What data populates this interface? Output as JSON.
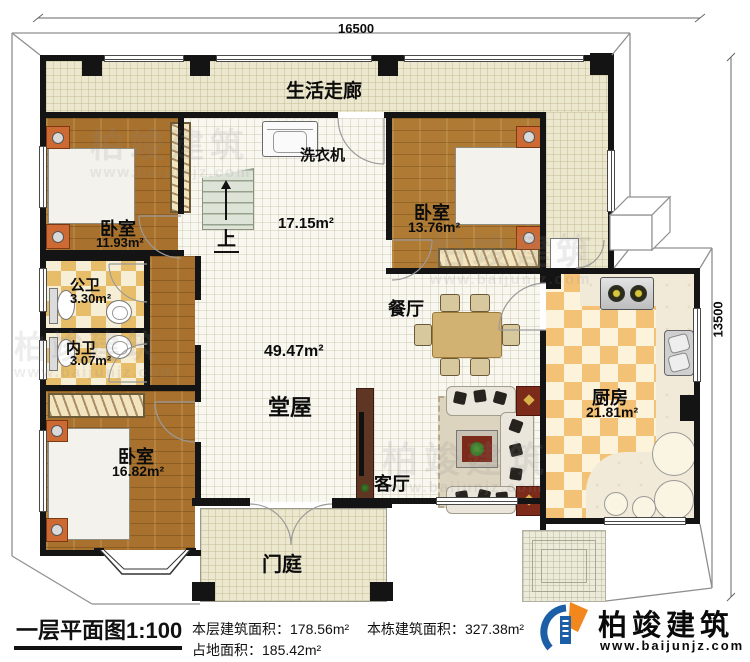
{
  "dimensions": {
    "top": "16500",
    "right": "13500"
  },
  "rooms": {
    "corridor": {
      "label": "生活走廊"
    },
    "laundry": {
      "appliance": "洗衣机",
      "area": "17.15m²"
    },
    "bedroom_tl": {
      "label": "卧室",
      "area": "11.93m²"
    },
    "bedroom_tr": {
      "label": "卧室",
      "area": "13.76m²"
    },
    "public_bath": {
      "label": "公卫",
      "area": "3.30m²"
    },
    "inner_bath": {
      "label": "内卫",
      "area": "3.07m²"
    },
    "dining": {
      "label": "餐厅"
    },
    "hall": {
      "label": "堂屋",
      "area": "49.47m²"
    },
    "kitchen": {
      "label": "厨房",
      "area": "21.81m²"
    },
    "bedroom_bl": {
      "label": "卧室",
      "area": "16.82m²"
    },
    "living": {
      "label": "客厅"
    },
    "porch": {
      "label": "门庭"
    }
  },
  "stairs": {
    "up_label": "上"
  },
  "footer": {
    "title": "一层平面图1:100",
    "floor_area_label": "本层建筑面积：",
    "floor_area_value": "178.56m²",
    "building_area_label": "本栋建筑面积：",
    "building_area_value": "327.38m²",
    "land_area_label": "占地面积：",
    "land_area_value": "185.42m²"
  },
  "brand": {
    "name": "柏竣建筑",
    "website": "www.baijunjz.com"
  },
  "watermark": {
    "text": "柏竣建筑",
    "url": "www.baijunjz.com"
  },
  "colors": {
    "wall": "#141414",
    "corridor_tile": "#ece8d0",
    "wood_floor": "#a8722e",
    "bath_checker": "#e7bd69",
    "kitchen_checker": "#f4c276",
    "bed_blue": "#72c4da",
    "mat_red": "#7c2a1a",
    "logo_blue": "#1d5fa7",
    "logo_orange": "#f2881d"
  }
}
